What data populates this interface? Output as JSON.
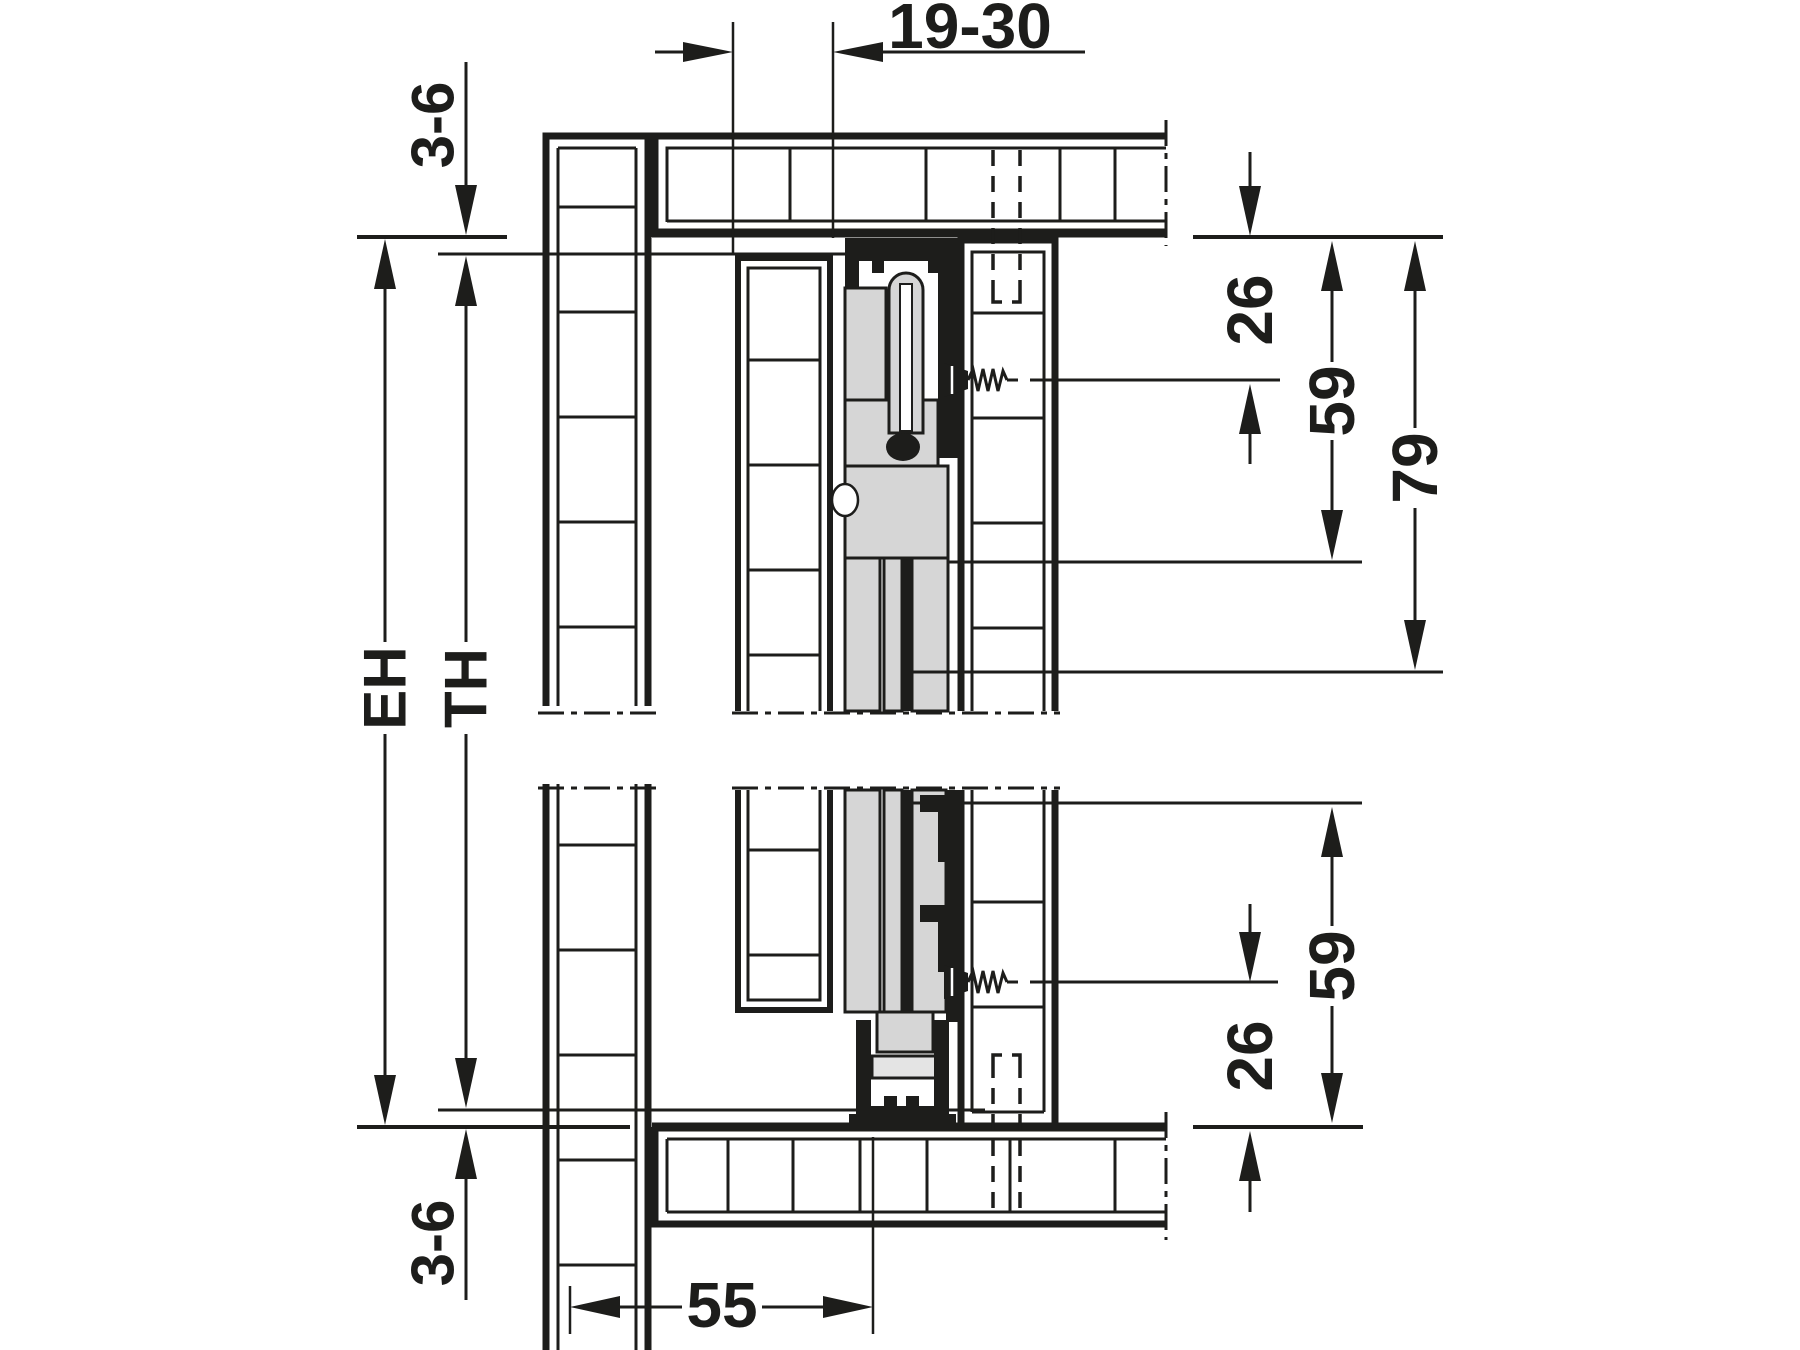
{
  "drawing": {
    "kind": "technical-cross-section-vertical",
    "labels": {
      "door_thickness": "19-30",
      "top_gap": "3-6",
      "bottom_gap": "3-6",
      "inner_height": "EH",
      "door_height": "TH",
      "top_screw_offset": "26",
      "top_fitting_depth": "59",
      "top_clearance_total": "79",
      "bottom_fitting_depth": "59",
      "bottom_screw_offset": "26",
      "bottom_inset": "55"
    },
    "colors": {
      "line": "#1d1d1b",
      "fitting_fill": "#d6d6d6",
      "fitting_fill_light": "#e4e4e4",
      "background": "#ffffff"
    }
  }
}
